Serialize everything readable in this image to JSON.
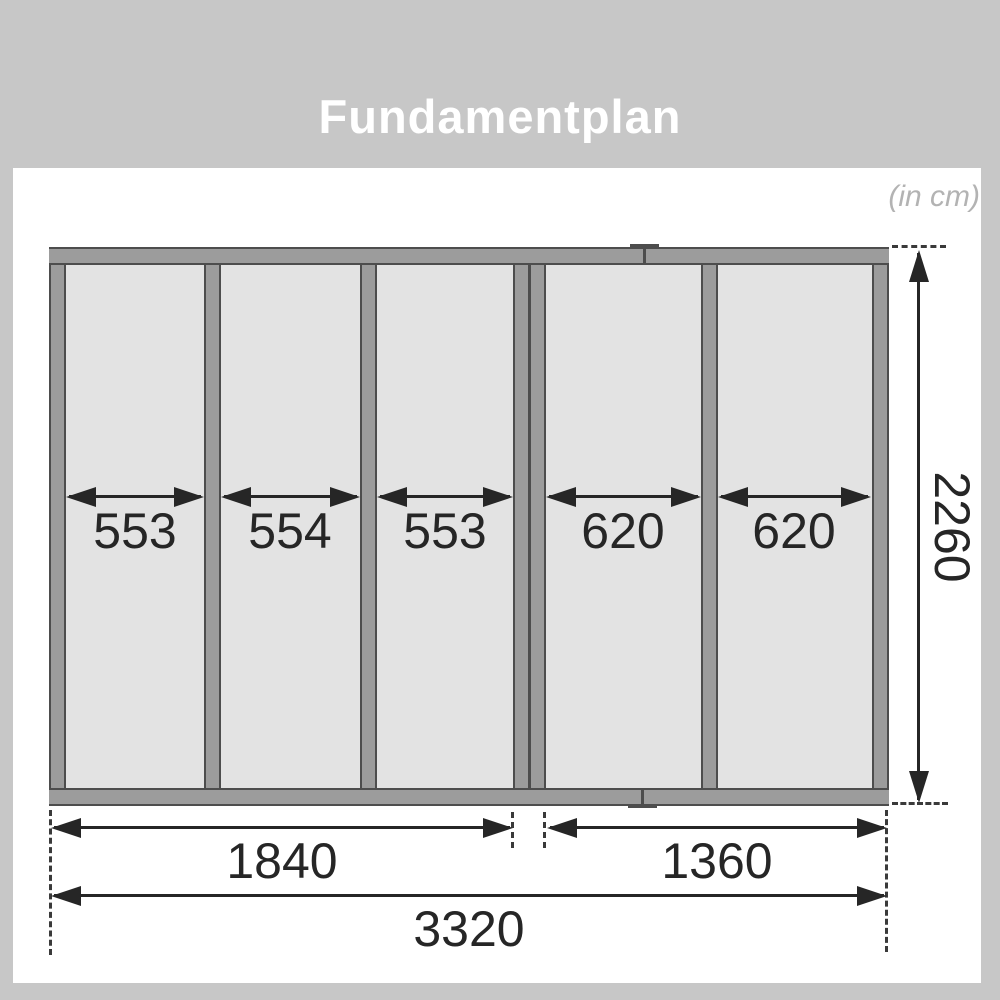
{
  "header": {
    "title": "Fundamentplan",
    "unit_note": "(in cm)"
  },
  "diagram": {
    "type": "foundation-plan",
    "section_widths": [
      "553",
      "554",
      "553",
      "620",
      "620"
    ],
    "bottom_dims": [
      "1840",
      "1360"
    ],
    "total_width": "3320",
    "height": "2260"
  },
  "colors": {
    "background": "#c7c7c7",
    "sheet": "#ffffff",
    "panel": "#e3e3e3",
    "beam": "#9c9c9c",
    "beam_edge": "#4d4d4d",
    "dimension": "#262626",
    "note_text": "#b3b3b3",
    "title_text": "#ffffff"
  }
}
